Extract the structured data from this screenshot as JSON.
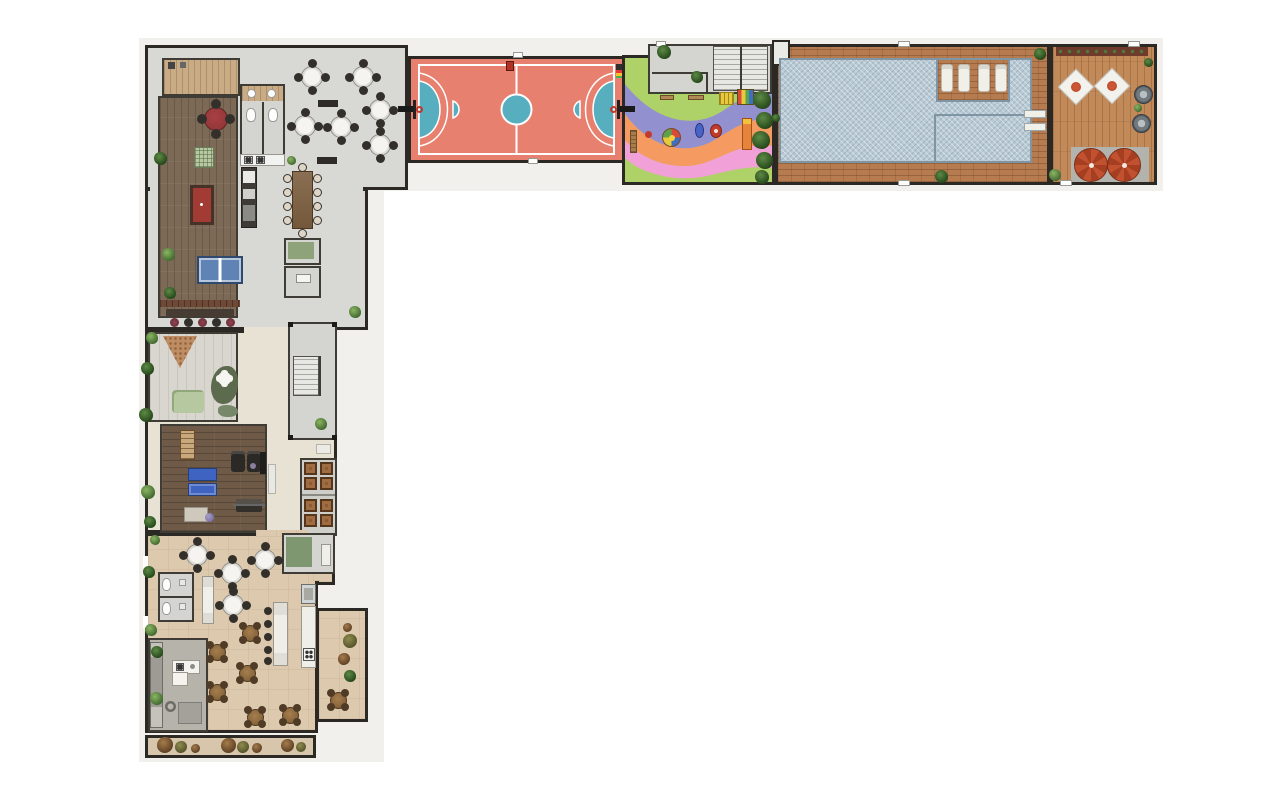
{
  "meta": {
    "title": "Residential amenities floor plan — aerial rendering",
    "type": "architectural floor plan, L-shaped amenity deck",
    "canvas": {
      "width": 1280,
      "height": 800
    }
  },
  "palette": {
    "wall": "#2c2925",
    "wall_light": "#3f3b35",
    "concrete": "#d8d8d4",
    "hall_floor": "#e8e2d5",
    "wood_dark": "#7c6a57",
    "gym_wood": "#6e5a47",
    "tan_wood": "#c9ac86",
    "court_red": "#e8806f",
    "court_blue": "#56aebf",
    "play_green": "#aed168",
    "play_purple": "#9390d0",
    "play_orange": "#f59a60",
    "play_pink": "#f2a0d8",
    "pool_tile": "#b9cad5",
    "pool_edge": "#7f95a3",
    "deck_brick": "#b67c50",
    "deck_wood": "#c28a58",
    "party_floor": "#dcc9ae",
    "patio_gray": "#b5b3aa",
    "umbrella_red": "#c1512f",
    "mat_blue": "#3f63c0",
    "billiard_red": "#a23b33",
    "pingpong_blue": "#5e83b4",
    "grill_brown": "#8a5c38",
    "stool_red": "#7e3b44"
  },
  "areas": {
    "locker_room": "Storage and lockers",
    "games_lounge": "Games lounge",
    "restrooms_upper": "Restrooms",
    "dining_lounge": "Dining and bar lounge",
    "pantry_rooms": "Service rooms",
    "sports_court": "Multi-sport court",
    "entry_hall": "Entry hall and staircase",
    "playground": "Playground",
    "pool": "Swimming pool",
    "pool_deck": "Pool deck",
    "sun_terrace": "Sun terrace with spas",
    "bar_nook": "Bar counter",
    "kids_room": "Kids playroom",
    "stairwell": "Stairwell",
    "gym": "Gym",
    "grill_stations": "Grill and storage stations",
    "party_room": "Party room",
    "restrooms_party": "Restrooms",
    "kitchen": "Kitchen and buffet",
    "gourmet_patio": "Gourmet patio",
    "party_terrace": "Side terrace",
    "garden_walk": "Garden walkway"
  },
  "inventory": {
    "games_lounge": [
      "round card table",
      "board-game table",
      "billiards table",
      "table-tennis table"
    ],
    "dining_lounge": [
      "6 round tables with 4 chairs",
      "10-seat communal table",
      "kitchen counter",
      "2 benches"
    ],
    "sports_court": [
      "2 basketball hoops",
      "futsal markings",
      "center circle",
      "scoreboard",
      "ball cart"
    ],
    "playground": [
      "carousel",
      "2 spring riders",
      "slide unit",
      "2 climbing frames",
      "bench",
      "hedge row"
    ],
    "pool": [
      "4 sun loungers on wet deck",
      "lap-lane section",
      "2 pool benches"
    ],
    "sun_terrace": [
      "2 daybeds",
      "2 round spas",
      "2 red umbrellas",
      "planter strip"
    ],
    "gym": [
      "wall bars",
      "2 blue mats",
      "2 treadmills",
      "bench press",
      "exercise ball",
      "floor mat"
    ],
    "kids_room": [
      "triangle rug",
      "bean-bag rug",
      "play mat",
      "flower table",
      "wavy bench"
    ],
    "party_room": [
      "4 round white tables",
      "7 round wood tables",
      "buffet counter",
      "kitchen with stove",
      "island kitchen"
    ],
    "garden_walk": [
      "shrub clusters"
    ]
  },
  "furniture": {
    "table_groups": [
      {
        "id": "dining-tables",
        "style": "white",
        "table_d": 22,
        "chair_d": 9,
        "chair_style": "dark",
        "angles": [
          0,
          90,
          180,
          270
        ],
        "centers": [
          [
            312,
            77
          ],
          [
            363,
            77
          ],
          [
            305,
            126
          ],
          [
            341,
            127
          ],
          [
            380,
            110
          ],
          [
            380,
            145
          ]
        ]
      },
      {
        "id": "party-tables-white",
        "style": "white",
        "table_d": 22,
        "chair_d": 9,
        "chair_style": "dark",
        "angles": [
          0,
          90,
          180,
          270
        ],
        "centers": [
          [
            197,
            555
          ],
          [
            232,
            573
          ],
          [
            265,
            560
          ],
          [
            233,
            605
          ]
        ]
      },
      {
        "id": "party-tables-wood",
        "style": "wood",
        "table_d": 17,
        "chair_d": 8,
        "chair_style": "brown",
        "angles": [
          45,
          135,
          225,
          315
        ],
        "centers": [
          [
            250,
            633
          ],
          [
            217,
            652
          ],
          [
            247,
            673
          ],
          [
            217,
            692
          ],
          [
            255,
            717
          ],
          [
            290,
            715
          ],
          [
            338,
            700
          ]
        ]
      }
    ],
    "dot_groups": [
      {
        "cls": "chair light",
        "d": 9,
        "name": "long-table-chair",
        "centers": [
          [
            287,
            178
          ],
          [
            287,
            192
          ],
          [
            287,
            206
          ],
          [
            287,
            220
          ],
          [
            317,
            178
          ],
          [
            317,
            192
          ],
          [
            317,
            206
          ],
          [
            317,
            220
          ],
          [
            302,
            167
          ],
          [
            302,
            233
          ]
        ]
      },
      {
        "cls": "chair dark",
        "d": 8,
        "name": "buffet-stool",
        "centers": [
          [
            268,
            611
          ],
          [
            268,
            624
          ],
          [
            268,
            637
          ],
          [
            268,
            650
          ],
          [
            268,
            661
          ]
        ]
      },
      {
        "cls": "chair dark",
        "d": 10,
        "name": "card-table-chair",
        "centers": [
          [
            216,
            104
          ],
          [
            230,
            119
          ],
          [
            216,
            134
          ],
          [
            202,
            119
          ]
        ]
      },
      {
        "cls": "stool red",
        "d": 9,
        "name": "bar-stool",
        "centers": [
          [
            174,
            322
          ],
          [
            202,
            322
          ],
          [
            230,
            322
          ]
        ]
      },
      {
        "cls": "stool dark",
        "d": 9,
        "name": "bar-stool",
        "centers": [
          [
            188,
            322
          ],
          [
            216,
            322
          ]
        ]
      }
    ]
  },
  "landscape": {
    "plants": [
      [
        160,
        158,
        13,
        "darkg"
      ],
      [
        168,
        254,
        13,
        "green"
      ],
      [
        170,
        293,
        12,
        "darkg"
      ],
      [
        291,
        160,
        9,
        "green"
      ],
      [
        355,
        312,
        12,
        "green"
      ],
      [
        152,
        338,
        12,
        "green"
      ],
      [
        147,
        368,
        13,
        "darkg"
      ],
      [
        146,
        415,
        14,
        "darkg"
      ],
      [
        148,
        492,
        14,
        "green"
      ],
      [
        150,
        522,
        12,
        "darkg"
      ],
      [
        321,
        424,
        12,
        "green"
      ],
      [
        155,
        540,
        10,
        "green"
      ],
      [
        149,
        572,
        12,
        "darkg"
      ],
      [
        151,
        630,
        12,
        "green"
      ],
      [
        157,
        652,
        12,
        "darkg"
      ],
      [
        156,
        698,
        13,
        "green"
      ],
      [
        664,
        52,
        14,
        "darkg"
      ],
      [
        697,
        77,
        12,
        "darkg"
      ],
      [
        762,
        100,
        18,
        "darkg"
      ],
      [
        764,
        120,
        17,
        "darkg"
      ],
      [
        761,
        140,
        18,
        "darkg"
      ],
      [
        764,
        160,
        17,
        "darkg"
      ],
      [
        762,
        177,
        14,
        "darkg"
      ],
      [
        1040,
        54,
        12,
        "darkg"
      ],
      [
        941,
        176,
        13,
        "darkg"
      ],
      [
        776,
        118,
        8,
        "darkg"
      ],
      [
        1055,
        175,
        12,
        "green"
      ],
      [
        1148,
        62,
        9,
        "darkg"
      ],
      [
        1138,
        108,
        8,
        "green"
      ]
    ],
    "shrubs": [
      [
        347,
        627,
        9,
        "brown"
      ],
      [
        350,
        641,
        14,
        "olive"
      ],
      [
        344,
        659,
        12,
        "brown"
      ],
      [
        350,
        676,
        12,
        "darkg"
      ],
      [
        165,
        745,
        16,
        "brown"
      ],
      [
        181,
        747,
        12,
        "olive"
      ],
      [
        195,
        748,
        9,
        "brown"
      ],
      [
        228,
        745,
        15,
        "brown"
      ],
      [
        243,
        747,
        12,
        "olive"
      ],
      [
        257,
        748,
        10,
        "brown"
      ],
      [
        287,
        745,
        13,
        "brown"
      ],
      [
        301,
        747,
        10,
        "olive"
      ]
    ]
  },
  "counts": {
    "pool_loungers": 4,
    "spas": 2,
    "daybeds": 2,
    "umbrellas": 2,
    "dining_round_tables": 6,
    "party_white_tables": 4,
    "party_wood_tables": 7,
    "grill_stations": 8,
    "bar_stools": 5
  }
}
